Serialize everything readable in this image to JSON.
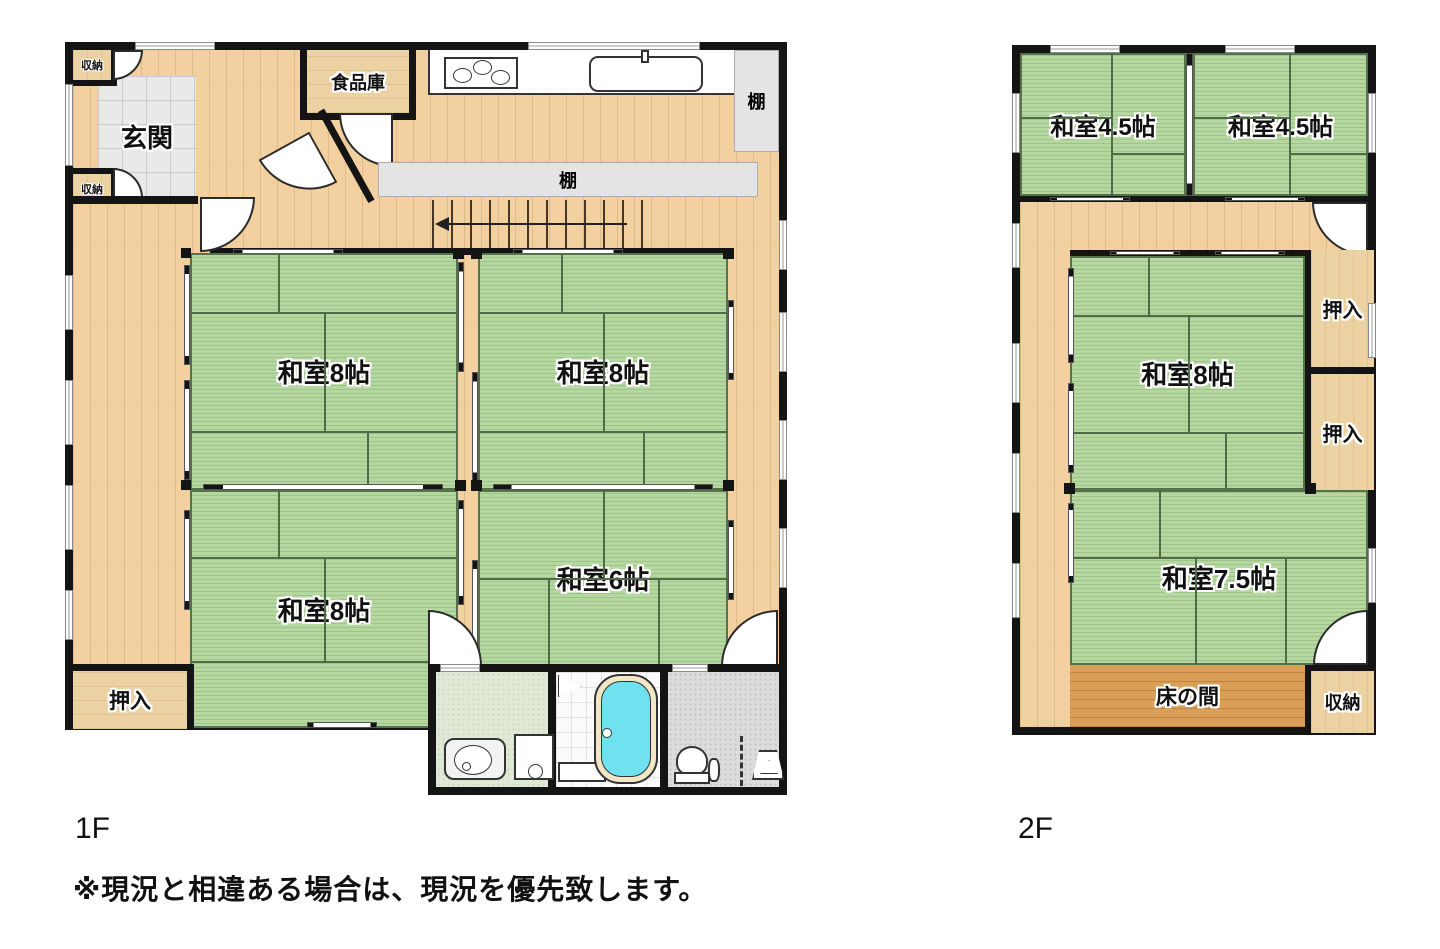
{
  "floor1": {
    "name": "1F",
    "labels": {
      "genkan": "玄関",
      "storage_top": "収納",
      "storage_mid": "収納",
      "pantry": "食品庫",
      "shelf_right": "棚",
      "shelf_center": "棚",
      "washitsu8_nw": "和室8帖",
      "washitsu8_ne": "和室8帖",
      "washitsu8_sw": "和室8帖",
      "washitsu6": "和室6帖",
      "oshiire": "押入"
    }
  },
  "floor2": {
    "name": "2F",
    "labels": {
      "washitsu45_w": "和室4.5帖",
      "washitsu45_e": "和室4.5帖",
      "washitsu8": "和室8帖",
      "oshiire_n": "押入",
      "oshiire_s": "押入",
      "washitsu75": "和室7.5帖",
      "tokonoma": "床の間",
      "shuno": "収納"
    }
  },
  "note": "※現況と相違ある場合は、現況を優先致します。",
  "colors": {
    "tatami": "#b5d8a0",
    "wood": "#f2d09f",
    "closet_wood": "#ecd2a2",
    "tokonoma_wood": "#d99f57",
    "wall": "#141414",
    "shelf_gray": "#e4e4e4",
    "bathtub": "#70e1ee",
    "entrance_tile": "#e9e9e9"
  }
}
